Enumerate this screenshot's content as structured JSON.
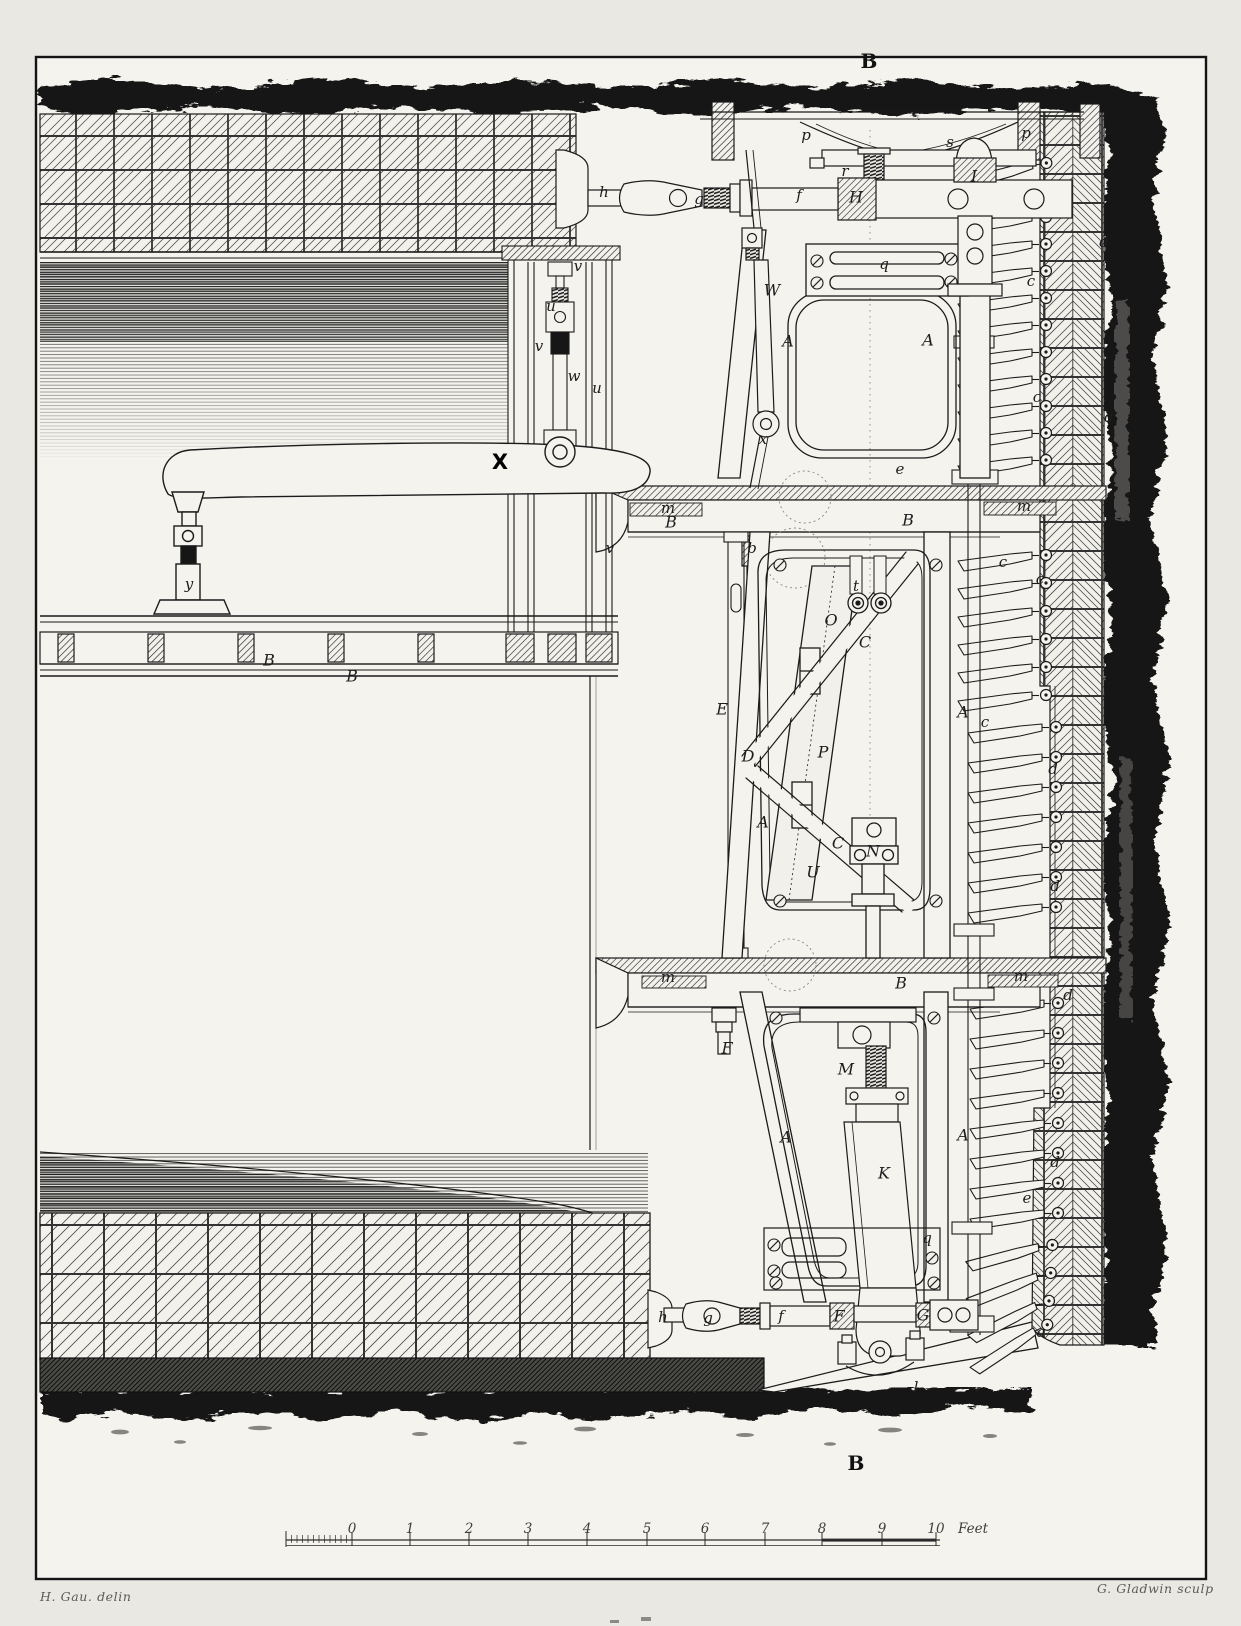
{
  "plate": {
    "section_marks": {
      "top": "B",
      "bottom": "B"
    },
    "scale_bar": {
      "unit_label": "Feet",
      "unit_x": 958,
      "label_y": 1521,
      "ticks": [
        {
          "label": "0",
          "x": 352
        },
        {
          "label": "1",
          "x": 410
        },
        {
          "label": "2",
          "x": 469
        },
        {
          "label": "3",
          "x": 528
        },
        {
          "label": "4",
          "x": 587
        },
        {
          "label": "5",
          "x": 647
        },
        {
          "label": "6",
          "x": 705
        },
        {
          "label": "7",
          "x": 765
        },
        {
          "label": "8",
          "x": 822
        },
        {
          "label": "9",
          "x": 882
        },
        {
          "label": "10",
          "x": 936
        }
      ]
    },
    "credits": {
      "left": "H. Gau. delin",
      "right": "G. Gladwin sculp"
    }
  },
  "part_labels": [
    {
      "text": "h",
      "x": 604,
      "y": 193,
      "kind": "lc"
    },
    {
      "text": "g",
      "x": 699,
      "y": 200,
      "kind": "lc"
    },
    {
      "text": "f",
      "x": 799,
      "y": 196,
      "kind": "lc"
    },
    {
      "text": "H",
      "x": 856,
      "y": 198,
      "kind": "uc"
    },
    {
      "text": "r",
      "x": 845,
      "y": 172,
      "kind": "lc"
    },
    {
      "text": "p",
      "x": 806,
      "y": 136,
      "kind": "lc"
    },
    {
      "text": "s",
      "x": 950,
      "y": 143,
      "kind": "lc"
    },
    {
      "text": "p",
      "x": 1026,
      "y": 134,
      "kind": "lc"
    },
    {
      "text": "I",
      "x": 974,
      "y": 177,
      "kind": "uc"
    },
    {
      "text": "q",
      "x": 884,
      "y": 265,
      "kind": "lc"
    },
    {
      "text": "W",
      "x": 772,
      "y": 291,
      "kind": "uc"
    },
    {
      "text": "A",
      "x": 788,
      "y": 342,
      "kind": "uc"
    },
    {
      "text": "A",
      "x": 928,
      "y": 341,
      "kind": "uc"
    },
    {
      "text": "x",
      "x": 763,
      "y": 440,
      "kind": "lc"
    },
    {
      "text": "v",
      "x": 578,
      "y": 267,
      "kind": "lc"
    },
    {
      "text": "u",
      "x": 551,
      "y": 307,
      "kind": "lc"
    },
    {
      "text": "v",
      "x": 539,
      "y": 347,
      "kind": "lc"
    },
    {
      "text": "w",
      "x": 574,
      "y": 377,
      "kind": "lc"
    },
    {
      "text": "u",
      "x": 597,
      "y": 389,
      "kind": "lc"
    },
    {
      "text": "X",
      "x": 500,
      "y": 463,
      "kind": "x"
    },
    {
      "text": "y",
      "x": 189,
      "y": 585,
      "kind": "lc"
    },
    {
      "text": "v",
      "x": 610,
      "y": 549,
      "kind": "lc"
    },
    {
      "text": "B",
      "x": 269,
      "y": 661,
      "kind": "uc"
    },
    {
      "text": "B",
      "x": 352,
      "y": 677,
      "kind": "uc"
    },
    {
      "text": "m",
      "x": 668,
      "y": 509,
      "kind": "lc"
    },
    {
      "text": "B",
      "x": 671,
      "y": 523,
      "kind": "uc"
    },
    {
      "text": "b",
      "x": 752,
      "y": 549,
      "kind": "lc"
    },
    {
      "text": "B",
      "x": 908,
      "y": 521,
      "kind": "uc"
    },
    {
      "text": "m",
      "x": 1024,
      "y": 507,
      "kind": "lc"
    },
    {
      "text": "e",
      "x": 900,
      "y": 470,
      "kind": "lc"
    },
    {
      "text": "t",
      "x": 856,
      "y": 587,
      "kind": "lc"
    },
    {
      "text": "O",
      "x": 831,
      "y": 621,
      "kind": "uc"
    },
    {
      "text": "C",
      "x": 865,
      "y": 643,
      "kind": "uc"
    },
    {
      "text": "E",
      "x": 722,
      "y": 710,
      "kind": "uc"
    },
    {
      "text": "A",
      "x": 963,
      "y": 713,
      "kind": "uc"
    },
    {
      "text": "D",
      "x": 748,
      "y": 757,
      "kind": "uc"
    },
    {
      "text": "P",
      "x": 823,
      "y": 753,
      "kind": "uc"
    },
    {
      "text": "A",
      "x": 763,
      "y": 823,
      "kind": "uc"
    },
    {
      "text": "C",
      "x": 838,
      "y": 844,
      "kind": "uc"
    },
    {
      "text": "N",
      "x": 873,
      "y": 852,
      "kind": "uc"
    },
    {
      "text": "U",
      "x": 813,
      "y": 873,
      "kind": "uc"
    },
    {
      "text": "c",
      "x": 1003,
      "y": 563,
      "kind": "lc"
    },
    {
      "text": "c",
      "x": 1040,
      "y": 580,
      "kind": "lc"
    },
    {
      "text": "m",
      "x": 668,
      "y": 978,
      "kind": "lc"
    },
    {
      "text": "B",
      "x": 901,
      "y": 984,
      "kind": "uc"
    },
    {
      "text": "m",
      "x": 1021,
      "y": 977,
      "kind": "lc"
    },
    {
      "text": "F",
      "x": 727,
      "y": 1049,
      "kind": "uc"
    },
    {
      "text": "M",
      "x": 846,
      "y": 1070,
      "kind": "uc"
    },
    {
      "text": "A",
      "x": 786,
      "y": 1138,
      "kind": "uc"
    },
    {
      "text": "A",
      "x": 963,
      "y": 1136,
      "kind": "uc"
    },
    {
      "text": "K",
      "x": 884,
      "y": 1174,
      "kind": "uc"
    },
    {
      "text": "q",
      "x": 927,
      "y": 1239,
      "kind": "lc"
    },
    {
      "text": "h",
      "x": 663,
      "y": 1318,
      "kind": "lc"
    },
    {
      "text": "g",
      "x": 708,
      "y": 1319,
      "kind": "lc"
    },
    {
      "text": "f",
      "x": 781,
      "y": 1317,
      "kind": "lc"
    },
    {
      "text": "F",
      "x": 839,
      "y": 1317,
      "kind": "uc"
    },
    {
      "text": "G",
      "x": 923,
      "y": 1316,
      "kind": "uc"
    },
    {
      "text": "l",
      "x": 916,
      "y": 1388,
      "kind": "lc"
    },
    {
      "text": "a",
      "x": 1041,
      "y": 1333,
      "kind": "lc"
    },
    {
      "text": "d",
      "x": 1104,
      "y": 243,
      "kind": "lc"
    },
    {
      "text": "c",
      "x": 1031,
      "y": 282,
      "kind": "lc"
    },
    {
      "text": "c",
      "x": 1037,
      "y": 398,
      "kind": "lc"
    },
    {
      "text": "d",
      "x": 1109,
      "y": 418,
      "kind": "lc"
    },
    {
      "text": "c",
      "x": 985,
      "y": 723,
      "kind": "lc"
    },
    {
      "text": "d",
      "x": 1053,
      "y": 770,
      "kind": "lc"
    },
    {
      "text": "d",
      "x": 1055,
      "y": 887,
      "kind": "lc"
    },
    {
      "text": "d",
      "x": 1068,
      "y": 996,
      "kind": "lc"
    },
    {
      "text": "d",
      "x": 1055,
      "y": 1163,
      "kind": "lc"
    },
    {
      "text": "e",
      "x": 1027,
      "y": 1199,
      "kind": "lc"
    }
  ],
  "colors": {
    "paper": "#f4f3ee",
    "margin": "#e9e8e3",
    "ink": "#1b1b1b",
    "earth": "#141413"
  }
}
